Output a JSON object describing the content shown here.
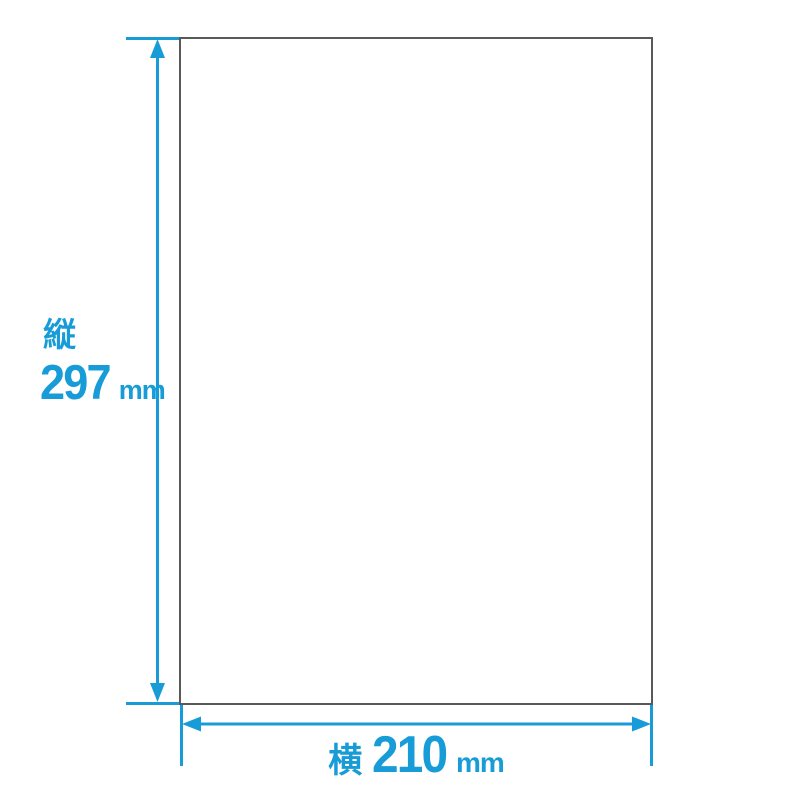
{
  "diagram": {
    "colors": {
      "accent": "#189CD8",
      "paper_border": "#595959",
      "background": "#FFFFFF"
    },
    "paper_outline": {
      "fill": "#FFFFFF"
    },
    "vertical_dimension": {
      "axis_label": "縦",
      "value": "297",
      "unit": "mm"
    },
    "horizontal_dimension": {
      "axis_label": "横",
      "value": "210",
      "unit": "mm"
    }
  }
}
